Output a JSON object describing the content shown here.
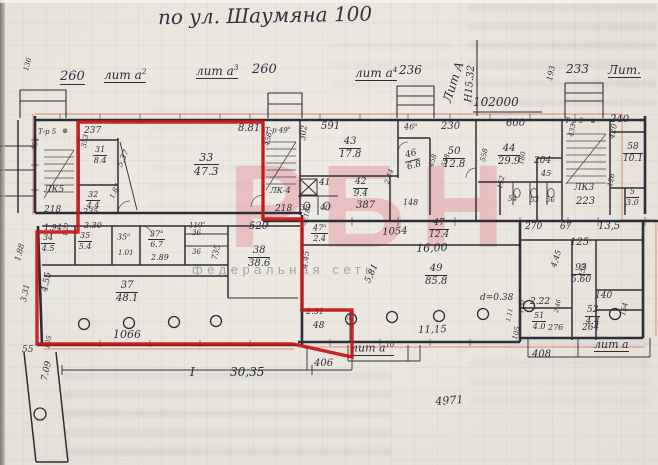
{
  "meta": {
    "title": "по ул. Шаумяна 100"
  },
  "watermark": {
    "logo": "РБН",
    "tagline": "федеральная сеть"
  },
  "colors": {
    "ink": "#2e2e38",
    "red": "#c81616",
    "salmon": "#e4776e",
    "pink": "#e598a1",
    "tag": "#96a09e",
    "paper": "#e9e6df"
  },
  "plan": {
    "labels": [
      {
        "t": "136",
        "x": 23,
        "y": 70,
        "f": 7,
        "r": -75
      },
      {
        "t": "260",
        "x": 60,
        "y": 70,
        "f": 13,
        "u": 1
      },
      {
        "t": "лит а",
        "sup": "2",
        "x": 104,
        "y": 68,
        "f": 12,
        "u": 1
      },
      {
        "t": "лит а",
        "sup": "3",
        "x": 196,
        "y": 64,
        "f": 12,
        "u": 1
      },
      {
        "t": "260",
        "x": 252,
        "y": 63,
        "f": 13
      },
      {
        "t": "лит а",
        "sup": "4",
        "x": 355,
        "y": 66,
        "f": 12,
        "u": 1
      },
      {
        "t": "236",
        "x": 399,
        "y": 64,
        "f": 12
      },
      {
        "t": "Лит А",
        "x": 441,
        "y": 100,
        "f": 12,
        "r": -72
      },
      {
        "t": "Н15.32",
        "x": 464,
        "y": 102,
        "f": 10,
        "r": -85
      },
      {
        "t": "102000",
        "x": 473,
        "y": 96,
        "f": 12
      },
      {
        "t": "193",
        "x": 546,
        "y": 80,
        "f": 8,
        "r": -78
      },
      {
        "t": "233",
        "x": 566,
        "y": 63,
        "f": 12
      },
      {
        "t": "Лит.",
        "x": 608,
        "y": 64,
        "f": 12,
        "u": 1
      },
      {
        "t": "240",
        "x": 610,
        "y": 115,
        "f": 10
      },
      {
        "t": "Т-р 5",
        "x": 38,
        "y": 129,
        "f": 7
      },
      {
        "t": "⊗",
        "x": 62,
        "y": 128,
        "f": 7
      },
      {
        "t": "454",
        "x": 31,
        "y": 150,
        "f": 7,
        "r": -78
      },
      {
        "t": "ЛК5",
        "x": 44,
        "y": 186,
        "f": 9
      },
      {
        "t": "218",
        "x": 44,
        "y": 206,
        "f": 9
      },
      {
        "t": "237",
        "x": 84,
        "y": 127,
        "f": 9
      },
      {
        "t": "353",
        "x": 81,
        "y": 147,
        "f": 7,
        "r": -80
      },
      {
        "t": "5,37",
        "x": 116,
        "y": 165,
        "f": 8,
        "r": -65
      },
      {
        "t": "235",
        "x": 83,
        "y": 208,
        "f": 8
      },
      {
        "t": "1.87",
        "x": 109,
        "y": 197,
        "f": 7,
        "r": -65
      },
      {
        "t": "8.81",
        "x": 238,
        "y": 124,
        "f": 10
      },
      {
        "t": "Т-р 49",
        "sup": "а",
        "x": 265,
        "y": 127,
        "f": 7
      },
      {
        "t": "458",
        "x": 264,
        "y": 145,
        "f": 7,
        "r": -78
      },
      {
        "t": "ЛК-4",
        "x": 270,
        "y": 187,
        "f": 8
      },
      {
        "t": "218",
        "x": 275,
        "y": 205,
        "f": 9
      },
      {
        "t": "302",
        "x": 299,
        "y": 140,
        "f": 8,
        "r": -83
      },
      {
        "t": "591",
        "x": 321,
        "y": 122,
        "f": 10
      },
      {
        "t": "46",
        "sup": "а",
        "x": 404,
        "y": 123,
        "f": 8
      },
      {
        "t": "230",
        "x": 441,
        "y": 122,
        "f": 10
      },
      {
        "t": "458",
        "x": 428,
        "y": 166,
        "f": 7,
        "r": -72
      },
      {
        "t": "558",
        "x": 441,
        "y": 166,
        "f": 7,
        "r": -72
      },
      {
        "t": "41",
        "x": 319,
        "y": 179,
        "f": 9
      },
      {
        "t": "387",
        "x": 356,
        "y": 201,
        "f": 10
      },
      {
        "t": "2.44",
        "x": 384,
        "y": 183,
        "f": 7,
        "r": -72
      },
      {
        "t": "39",
        "x": 300,
        "y": 204,
        "f": 8
      },
      {
        "t": "40",
        "x": 320,
        "y": 204,
        "f": 8
      },
      {
        "t": "148",
        "x": 403,
        "y": 199,
        "f": 8
      },
      {
        "t": "600",
        "x": 506,
        "y": 119,
        "f": 10
      },
      {
        "t": "558",
        "x": 480,
        "y": 161,
        "f": 7,
        "r": -78
      },
      {
        "t": "204",
        "x": 534,
        "y": 157,
        "f": 9
      },
      {
        "t": "45",
        "x": 541,
        "y": 170,
        "f": 8
      },
      {
        "t": "180",
        "x": 518,
        "y": 164,
        "f": 7,
        "r": -78
      },
      {
        "t": "Т-р 3",
        "x": 565,
        "y": 118,
        "f": 7
      },
      {
        "t": "⊗",
        "x": 590,
        "y": 118,
        "f": 7
      },
      {
        "t": "433",
        "x": 568,
        "y": 136,
        "f": 7,
        "r": -78
      },
      {
        "t": "ЛК3",
        "x": 574,
        "y": 184,
        "f": 9
      },
      {
        "t": "223",
        "x": 576,
        "y": 197,
        "f": 10
      },
      {
        "t": "420",
        "x": 608,
        "y": 138,
        "f": 8,
        "r": -78
      },
      {
        "t": "126",
        "x": 607,
        "y": 186,
        "f": 7,
        "r": -78
      },
      {
        "t": "54",
        "x": 508,
        "y": 196,
        "f": 7
      },
      {
        "t": "53",
        "x": 530,
        "y": 197,
        "f": 7
      },
      {
        "t": "56",
        "x": 546,
        "y": 197,
        "f": 7
      },
      {
        "t": "152",
        "x": 497,
        "y": 188,
        "f": 7,
        "r": -78
      },
      {
        "t": "520",
        "x": 249,
        "y": 222,
        "f": 10
      },
      {
        "t": "1.18",
        "x": 302,
        "y": 223,
        "f": 7,
        "r": -78
      },
      {
        "t": "1054",
        "x": 382,
        "y": 228,
        "f": 10,
        "r": -3
      },
      {
        "t": "16,00",
        "x": 416,
        "y": 243,
        "f": 11,
        "r": -2
      },
      {
        "t": "270",
        "x": 525,
        "y": 223,
        "f": 9
      },
      {
        "t": "67",
        "x": 560,
        "y": 223,
        "f": 9
      },
      {
        "t": "13,5",
        "x": 598,
        "y": 222,
        "f": 10
      },
      {
        "t": "125",
        "x": 570,
        "y": 238,
        "f": 10
      },
      {
        "t": "1.94",
        "x": 44,
        "y": 224,
        "f": 8
      },
      {
        "t": "2.30",
        "x": 84,
        "y": 222,
        "f": 8
      },
      {
        "t": "1.20",
        "x": 63,
        "y": 236,
        "f": 6,
        "r": -83
      },
      {
        "t": "35",
        "sup": "а",
        "x": 117,
        "y": 233,
        "f": 8
      },
      {
        "t": "1.01",
        "x": 118,
        "y": 250,
        "f": 7
      },
      {
        "t": "2.89",
        "x": 151,
        "y": 254,
        "f": 8
      },
      {
        "t": "110",
        "sup": "а",
        "x": 189,
        "y": 222,
        "f": 7
      },
      {
        "t": "36",
        "x": 192,
        "y": 230,
        "f": 7
      },
      {
        "t": "36",
        "x": 192,
        "y": 249,
        "f": 7
      },
      {
        "t": "735",
        "x": 211,
        "y": 259,
        "f": 8,
        "r": -78
      },
      {
        "t": "4.55",
        "x": 41,
        "y": 291,
        "f": 9,
        "r": -78
      },
      {
        "t": "1066",
        "x": 113,
        "y": 329,
        "f": 11
      },
      {
        "t": "1.88",
        "x": 14,
        "y": 260,
        "f": 8,
        "r": -75
      },
      {
        "t": "3.31",
        "x": 20,
        "y": 301,
        "f": 8,
        "r": -78
      },
      {
        "t": "55",
        "x": 22,
        "y": 346,
        "f": 9
      },
      {
        "t": "105",
        "x": 44,
        "y": 348,
        "f": 7,
        "r": -78
      },
      {
        "t": "7.09",
        "x": 41,
        "y": 380,
        "f": 9,
        "r": -78
      },
      {
        "t": "4.45",
        "x": 301,
        "y": 268,
        "f": 8,
        "r": -83
      },
      {
        "t": "5,81",
        "x": 364,
        "y": 281,
        "f": 9,
        "r": -65
      },
      {
        "t": "d=0.38",
        "x": 480,
        "y": 294,
        "f": 9
      },
      {
        "t": "2.31",
        "x": 306,
        "y": 308,
        "f": 8
      },
      {
        "t": "48",
        "x": 313,
        "y": 322,
        "f": 9
      },
      {
        "t": "1.50",
        "x": 347,
        "y": 326,
        "f": 6,
        "r": -83
      },
      {
        "t": "11,15",
        "x": 418,
        "y": 326,
        "f": 10,
        "r": -2
      },
      {
        "t": "лит а",
        "sup": "10",
        "x": 351,
        "y": 342,
        "f": 11,
        "u": 1
      },
      {
        "t": "406",
        "x": 314,
        "y": 359,
        "f": 10
      },
      {
        "t": "I",
        "x": 190,
        "y": 366,
        "f": 12
      },
      {
        "t": "30,35",
        "x": 230,
        "y": 366,
        "f": 12
      },
      {
        "t": "4971",
        "x": 435,
        "y": 396,
        "f": 11,
        "r": -4
      },
      {
        "t": "4,45",
        "x": 550,
        "y": 266,
        "f": 8,
        "r": -72
      },
      {
        "t": "450",
        "x": 578,
        "y": 276,
        "f": 7,
        "r": -72
      },
      {
        "t": "140",
        "x": 595,
        "y": 292,
        "f": 9
      },
      {
        "t": "2.22",
        "x": 530,
        "y": 298,
        "f": 9
      },
      {
        "t": "1,50",
        "x": 519,
        "y": 313,
        "f": 6,
        "r": -83
      },
      {
        "t": "1.11",
        "x": 506,
        "y": 321,
        "f": 6,
        "r": -78
      },
      {
        "t": "2,46",
        "x": 554,
        "y": 312,
        "f": 6,
        "r": -78
      },
      {
        "t": "276",
        "x": 548,
        "y": 324,
        "f": 8
      },
      {
        "t": "264",
        "x": 582,
        "y": 324,
        "f": 9
      },
      {
        "t": "154",
        "x": 620,
        "y": 315,
        "f": 7,
        "r": -78
      },
      {
        "t": "105",
        "x": 512,
        "y": 339,
        "f": 7,
        "r": -78
      },
      {
        "t": "408",
        "x": 532,
        "y": 350,
        "f": 10
      },
      {
        "t": "лит а",
        "x": 594,
        "y": 339,
        "f": 11,
        "u": 1
      }
    ],
    "rooms": [
      {
        "n": "31",
        "d": "8.4",
        "x": 93,
        "y": 146,
        "f": 8
      },
      {
        "n": "32",
        "d": "4.4",
        "x": 86,
        "y": 191,
        "f": 8
      },
      {
        "n": "33",
        "d": "47.3",
        "x": 194,
        "y": 152,
        "f": 11
      },
      {
        "n": "43",
        "d": "17.8",
        "x": 339,
        "y": 137,
        "f": 10
      },
      {
        "n": "46",
        "d": "6.8",
        "x": 405,
        "y": 150,
        "f": 9,
        "r": -15
      },
      {
        "n": "50",
        "d": "12.8",
        "x": 443,
        "y": 147,
        "f": 10
      },
      {
        "n": "44",
        "d": "29.9",
        "x": 498,
        "y": 144,
        "f": 10
      },
      {
        "n": "42",
        "d": "9.4",
        "x": 353,
        "y": 178,
        "f": 9
      },
      {
        "n": "58",
        "d": "10.1",
        "x": 623,
        "y": 143,
        "f": 9
      },
      {
        "n": "5",
        "d": "3.0",
        "x": 626,
        "y": 188,
        "f": 8
      },
      {
        "n": "47",
        "sup": "а",
        "d": "2.4",
        "x": 311,
        "y": 224,
        "f": 8
      },
      {
        "n": "47",
        "d": "12.4",
        "x": 429,
        "y": 219,
        "f": 9
      },
      {
        "n": "34",
        "d": "4.5",
        "x": 41,
        "y": 234,
        "f": 8
      },
      {
        "n": "35",
        "d": "5.4",
        "x": 78,
        "y": 232,
        "f": 8
      },
      {
        "n": "37",
        "sup": "а",
        "d": "6.7",
        "x": 148,
        "y": 230,
        "f": 8
      },
      {
        "n": "38",
        "d": "38.6",
        "x": 248,
        "y": 246,
        "f": 10
      },
      {
        "n": "37",
        "d": "48.1",
        "x": 116,
        "y": 281,
        "f": 10
      },
      {
        "n": "49",
        "d": "85.8",
        "x": 425,
        "y": 264,
        "f": 10
      },
      {
        "n": "93",
        "d": "5.60",
        "x": 571,
        "y": 264,
        "f": 9
      },
      {
        "n": "51",
        "d": "4.0",
        "x": 532,
        "y": 312,
        "f": 8
      },
      {
        "n": "52",
        "d": "4.4",
        "x": 585,
        "y": 306,
        "f": 9
      }
    ]
  }
}
